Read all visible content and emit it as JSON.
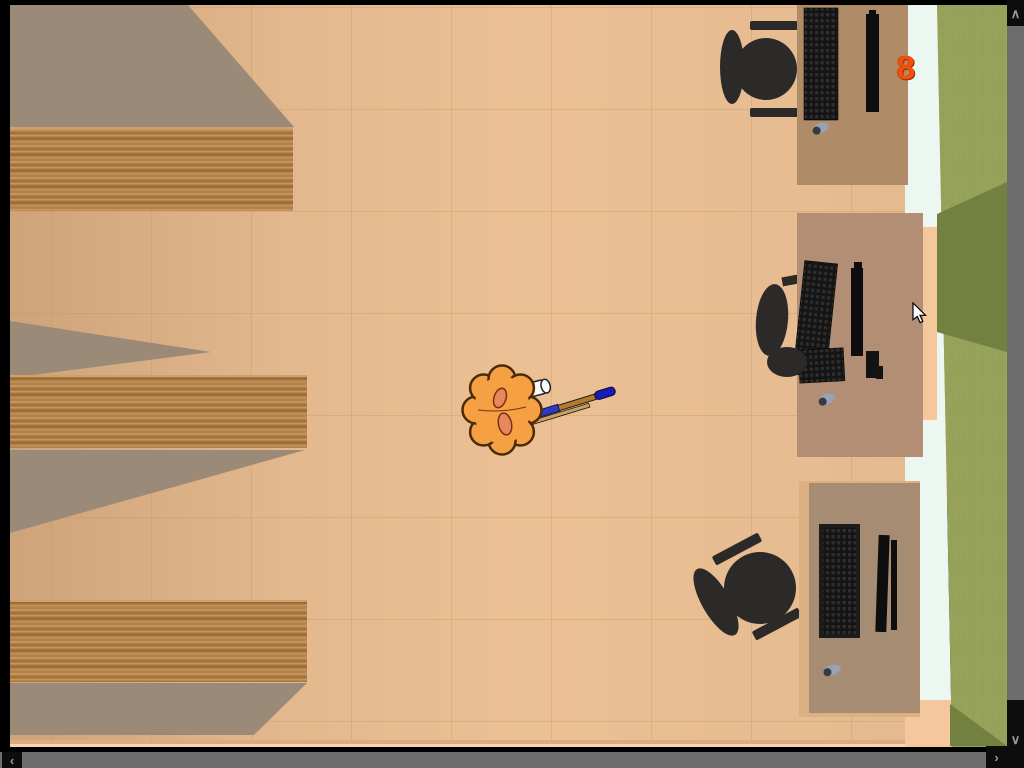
{
  "hud": {
    "score": "8"
  },
  "scrollbars": {
    "up_glyph": "∧",
    "down_glyph": "∨",
    "left_glyph": "‹",
    "right_glyph": "›"
  },
  "scene": {
    "view": "top-down room",
    "character": "orange-suited figure holding broom-stick with blue tip",
    "furniture": [
      "wooden shelf",
      "wooden shelf",
      "wooden shelf",
      "computer desk with keyboard, monitor, mouse and chair",
      "computer desk with keyboard, monitor, mouse and chair",
      "computer desk with keyboard, monitor, mouse and chair"
    ]
  },
  "colors": {
    "floor": "#ecc095",
    "shadow": "#9c8a79",
    "wood": "#b2814c",
    "desk_top": "#b08b68",
    "desk_middle": "#b18e74",
    "desk_bottom": "#a78c74",
    "desk_frame": "#dcb083",
    "chair": "#2b2a28",
    "keyboard": "#141414",
    "monitor": "#0e0e0e",
    "mouse": "#98a2b4",
    "wall_white": "#edf7f2",
    "wall_peach": "#f4c89c",
    "grass": "#96a159",
    "grass_dark": "#72813f",
    "scrollbar_track": "#6d6d6d",
    "scrollbar_button": "#0d0d0d",
    "scrollbar_arrow": "#9a9a9a",
    "character_body": "#f5a043",
    "character_inner": "#e8875c",
    "sleeve": "#fafafa",
    "stick": "#b5792e",
    "stick_tip": "#1b1bb0",
    "score": "#f2500c",
    "border": "#000000"
  }
}
